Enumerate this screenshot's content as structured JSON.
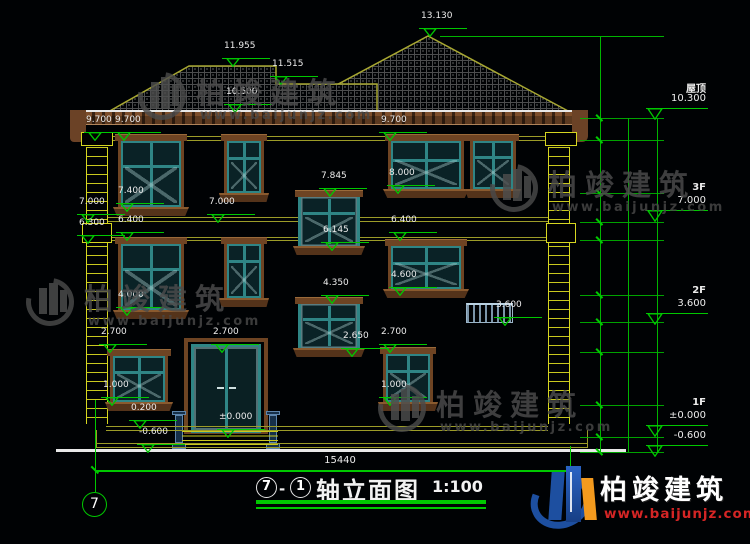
{
  "title_bar": {
    "axis_a": "7",
    "dash": "-",
    "axis_b": "1",
    "title": "轴立面图",
    "scale": "1:100"
  },
  "axis_bubble": {
    "label": "7"
  },
  "bottom_dim": {
    "label": "15440"
  },
  "floor_markers": [
    {
      "name": "屋顶",
      "elev": "10.300",
      "x": 646,
      "y": 80
    },
    {
      "name": "3F",
      "elev": "7.000",
      "x": 646,
      "y": 182
    },
    {
      "name": "2F",
      "elev": "3.600",
      "x": 646,
      "y": 285
    },
    {
      "name": "1F",
      "elev": "±0.000",
      "x": 646,
      "y": 397
    },
    {
      "name": "",
      "elev": "-0.600",
      "x": 646,
      "y": 417
    }
  ],
  "markers": [
    {
      "label": "13.130",
      "x": 416,
      "y": 10
    },
    {
      "label": "11.955",
      "x": 219,
      "y": 40
    },
    {
      "label": "11.515",
      "x": 267,
      "y": 58
    },
    {
      "label": "10.500",
      "x": 221,
      "y": 86
    },
    {
      "label": "9.700",
      "x": 81,
      "y": 114
    },
    {
      "label": "9.700",
      "x": 110,
      "y": 114
    },
    {
      "label": "9.700",
      "x": 376,
      "y": 114
    },
    {
      "label": "8.000",
      "x": 384,
      "y": 167
    },
    {
      "label": "7.845",
      "x": 316,
      "y": 170
    },
    {
      "label": "7.400",
      "x": 113,
      "y": 185
    },
    {
      "label": "7.000",
      "x": 74,
      "y": 196
    },
    {
      "label": "7.000",
      "x": 204,
      "y": 196
    },
    {
      "label": "6.400",
      "x": 113,
      "y": 214
    },
    {
      "label": "6.400",
      "x": 386,
      "y": 214
    },
    {
      "label": "6.300",
      "x": 74,
      "y": 217
    },
    {
      "label": "6.145",
      "x": 318,
      "y": 224
    },
    {
      "label": "4.600",
      "x": 386,
      "y": 269
    },
    {
      "label": "4.350",
      "x": 318,
      "y": 277
    },
    {
      "label": "4.000",
      "x": 113,
      "y": 289
    },
    {
      "label": "3.600",
      "x": 491,
      "y": 299
    },
    {
      "label": "2.700",
      "x": 96,
      "y": 326
    },
    {
      "label": "2.700",
      "x": 208,
      "y": 326
    },
    {
      "label": "2.700",
      "x": 376,
      "y": 326
    },
    {
      "label": "2.650",
      "x": 338,
      "y": 330
    },
    {
      "label": "1.000",
      "x": 98,
      "y": 379
    },
    {
      "label": "1.000",
      "x": 376,
      "y": 379
    },
    {
      "label": "0.200",
      "x": 126,
      "y": 402
    },
    {
      "label": "±0.000",
      "x": 214,
      "y": 411
    },
    {
      "label": "-0.600",
      "x": 134,
      "y": 426
    }
  ],
  "dim_col1": [
    {
      "label": "2830",
      "x": 586,
      "y": 77
    },
    {
      "label": "600",
      "x": 586,
      "y": 129
    },
    {
      "label": "1700",
      "x": 586,
      "y": 166
    },
    {
      "label": "1000",
      "x": 586,
      "y": 207
    },
    {
      "label": "600",
      "x": 586,
      "y": 231
    },
    {
      "label": "1800",
      "x": 586,
      "y": 267
    },
    {
      "label": "1000",
      "x": 586,
      "y": 308
    },
    {
      "label": "900",
      "x": 586,
      "y": 337
    },
    {
      "label": "1700",
      "x": 586,
      "y": 378
    },
    {
      "label": "1000",
      "x": 586,
      "y": 421
    },
    {
      "label": "600",
      "x": 586,
      "y": 444
    }
  ],
  "dim_col2": [
    {
      "label": "3300",
      "x": 616,
      "y": 170
    },
    {
      "label": "3400",
      "x": 616,
      "y": 272
    },
    {
      "label": "3600",
      "x": 616,
      "y": 379
    },
    {
      "label": "600",
      "x": 616,
      "y": 444
    }
  ],
  "dim_col3": [
    {
      "label": "10900",
      "x": 645,
      "y": 285
    }
  ],
  "watermarks": [
    {
      "name": "柏竣建筑",
      "url": "www.baijunjz.com",
      "x": 138,
      "y": 70
    },
    {
      "name": "柏竣建筑",
      "url": "www.baijunjz.com",
      "x": 490,
      "y": 162
    },
    {
      "name": "柏竣建筑",
      "url": "www.baijunjz.com",
      "x": 26,
      "y": 276
    },
    {
      "name": "柏竣建筑",
      "url": "www.baijunjz.com",
      "x": 378,
      "y": 382
    }
  ],
  "brand": {
    "name": "柏竣建筑",
    "url": "www.baijunjz.com"
  }
}
